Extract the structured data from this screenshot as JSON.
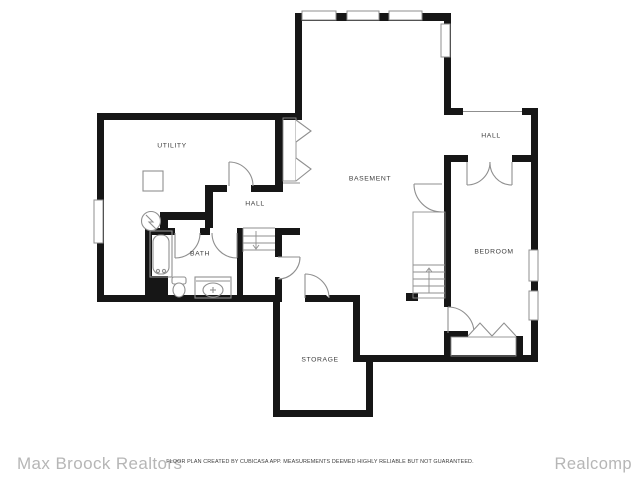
{
  "canvas": {
    "width": 640,
    "height": 480,
    "background": "#ffffff"
  },
  "colors": {
    "wall": "#161616",
    "symbol": "#8f8f8f",
    "label": "#3d3d3d",
    "brand_text": "#b6b6b6",
    "disclaimer_text": "#3d3d3d"
  },
  "rooms": [
    {
      "id": "utility",
      "label": "UTILITY"
    },
    {
      "id": "basement",
      "label": "BASEMENT"
    },
    {
      "id": "hall-upper",
      "label": "HALL"
    },
    {
      "id": "bedroom",
      "label": "BEDROOM"
    },
    {
      "id": "hall-lower",
      "label": "HALL"
    },
    {
      "id": "bath",
      "label": "BATH"
    },
    {
      "id": "storage",
      "label": "STORAGE"
    }
  ],
  "symbols": [
    "window",
    "door-swing",
    "double-door",
    "bifold-door",
    "stairs-down",
    "stairs-up",
    "bathtub",
    "toilet",
    "sink-vanity",
    "water-heater",
    "sump-pump",
    "closet"
  ],
  "footer": {
    "brand_left": "Max Broock Realtors",
    "disclaimer": "FLOOR PLAN CREATED BY CUBICASA APP. MEASUREMENTS DEEMED HIGHLY RELIABLE BUT NOT GUARANTEED.",
    "brand_right": "Realcomp"
  }
}
